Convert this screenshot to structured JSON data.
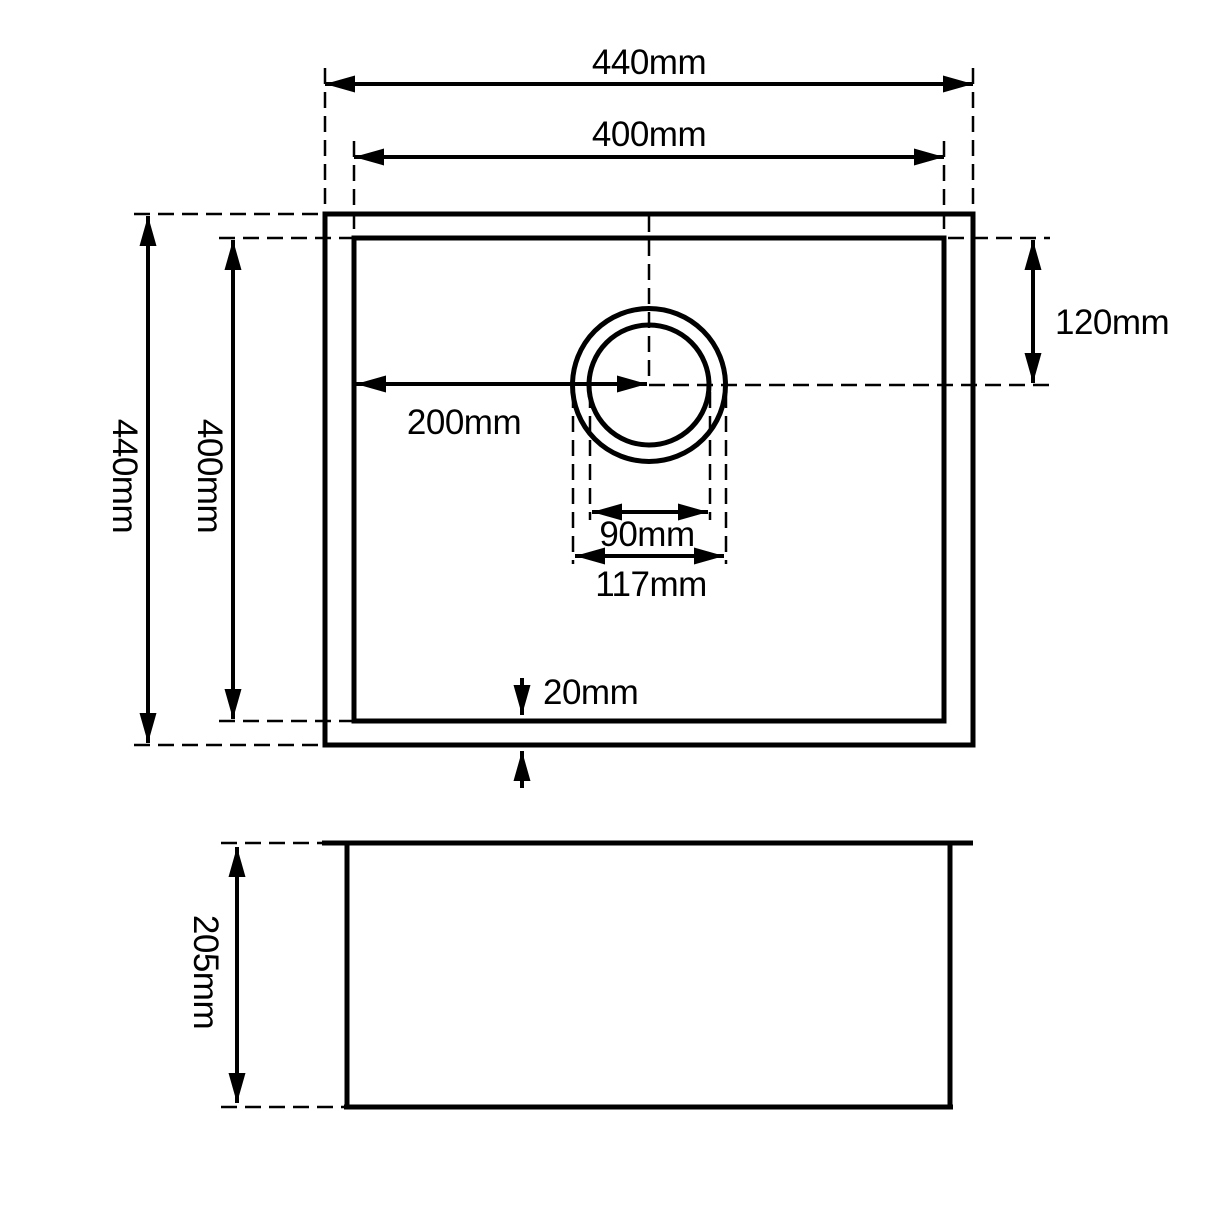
{
  "drawing": {
    "kind": "sink-dimension-diagram",
    "colors": {
      "line": "#000000",
      "background": "#ffffff"
    },
    "top_view": {
      "outer_width": "440mm",
      "inner_width": "400mm",
      "outer_depth": "440mm",
      "inner_depth": "400mm",
      "drain_center_from_left": "200mm",
      "drain_center_from_top": "120mm",
      "drain_inner_diameter": "90mm",
      "drain_outer_diameter": "117mm",
      "rim_thickness": "20mm"
    },
    "side_view": {
      "bowl_depth": "205mm"
    }
  }
}
